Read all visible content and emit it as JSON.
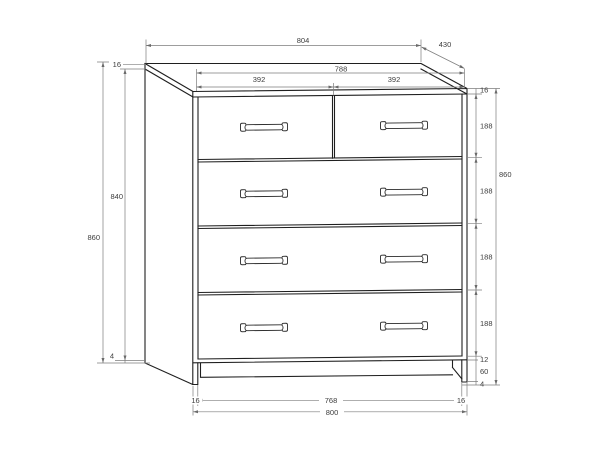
{
  "drawing": {
    "subject": "chest-of-drawers-dimension-drawing",
    "units_shown": "",
    "dims": {
      "top": {
        "overall_width": "804",
        "depth": "430",
        "inner_width": "788",
        "left_drawer": "392",
        "right_drawer": "392"
      },
      "left": {
        "top_panel": "16",
        "side_height": "840",
        "total_height": "860",
        "bottom": "4"
      },
      "right": {
        "top_panel": "16",
        "drawer1": "188",
        "drawer2": "188",
        "drawer3": "188",
        "drawer4": "188",
        "bottom_panel": "12",
        "plinth": "60",
        "foot": "4",
        "total_height": "860"
      },
      "bottom": {
        "left_inset": "16",
        "plinth_width": "768",
        "right_inset": "16",
        "overall_width": "800"
      }
    }
  }
}
